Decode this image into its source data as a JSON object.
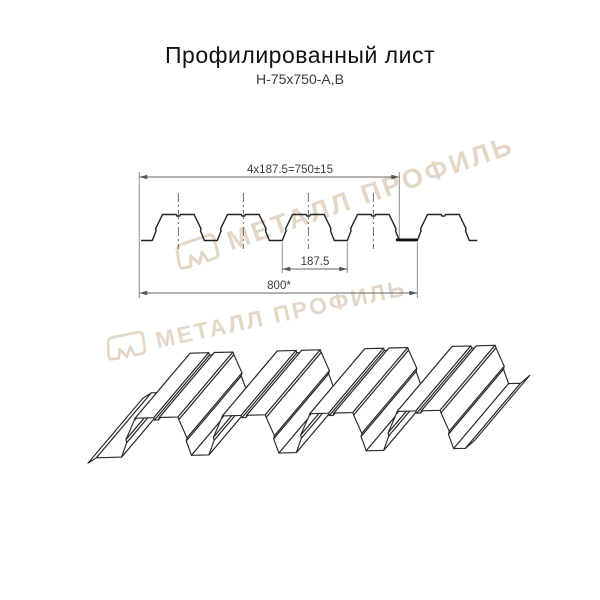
{
  "header": {
    "title": "Профилированный лист",
    "subtitle": "Н-75х750-А,В"
  },
  "diagram": {
    "dimensions": {
      "top": "4х187.5=750±15",
      "middle": "187.5",
      "bottom": "800*"
    },
    "profile": {
      "name": "Н-75",
      "pitch_mm": 187.5,
      "height_mm": 75,
      "working_width_mm": 750,
      "overall_width_mm": 800,
      "rib_top_width_mm": 92,
      "rib_base_width_mm": 150,
      "ribs_in_section": 5,
      "ribs_in_iso_view": 4
    },
    "colors": {
      "line": "#222222",
      "iso_line": "#2b2b2b",
      "dim_line": "#8f8f8f",
      "dim_text": "#3c3c3c",
      "thick_segment": "#111111",
      "watermark": "#e5d7c7"
    }
  },
  "watermark": {
    "text": "МЕТАЛЛ ПРОФИЛЬ",
    "logo": "metall-profil-logo"
  }
}
